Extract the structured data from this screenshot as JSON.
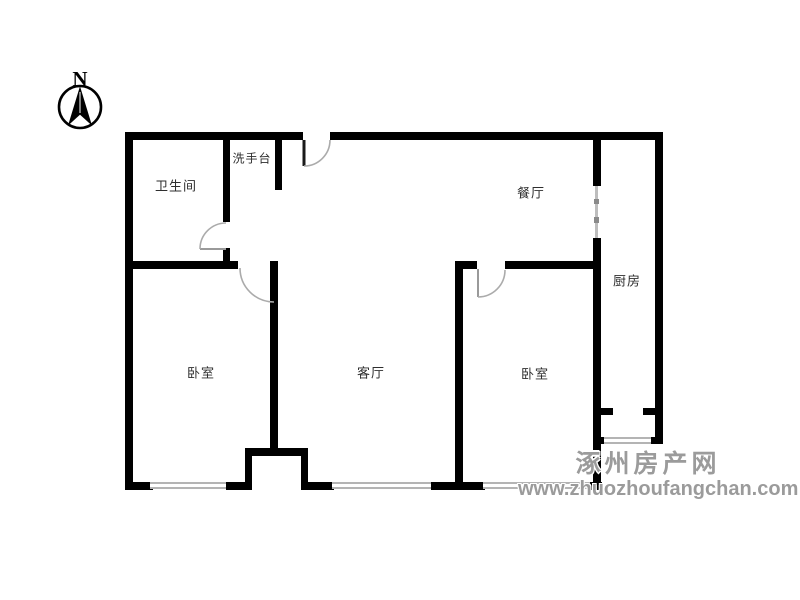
{
  "compass": {
    "letter": "N"
  },
  "rooms": {
    "bathroom": "卫生间",
    "washbasin": "洗手台",
    "dining": "餐厅",
    "kitchen": "厨房",
    "bedroom_left": "卧室",
    "living": "客厅",
    "bedroom_right": "卧室"
  },
  "watermark": {
    "site_name": "涿州房产网",
    "site_url": "www.zhuozhoufangchan.com"
  },
  "colors": {
    "wall": "#000000",
    "window_line": "#b4b4b4",
    "door_arc": "#ababab",
    "label_text": "#2e2e2e",
    "watermark_text": "#9b9b9b"
  }
}
